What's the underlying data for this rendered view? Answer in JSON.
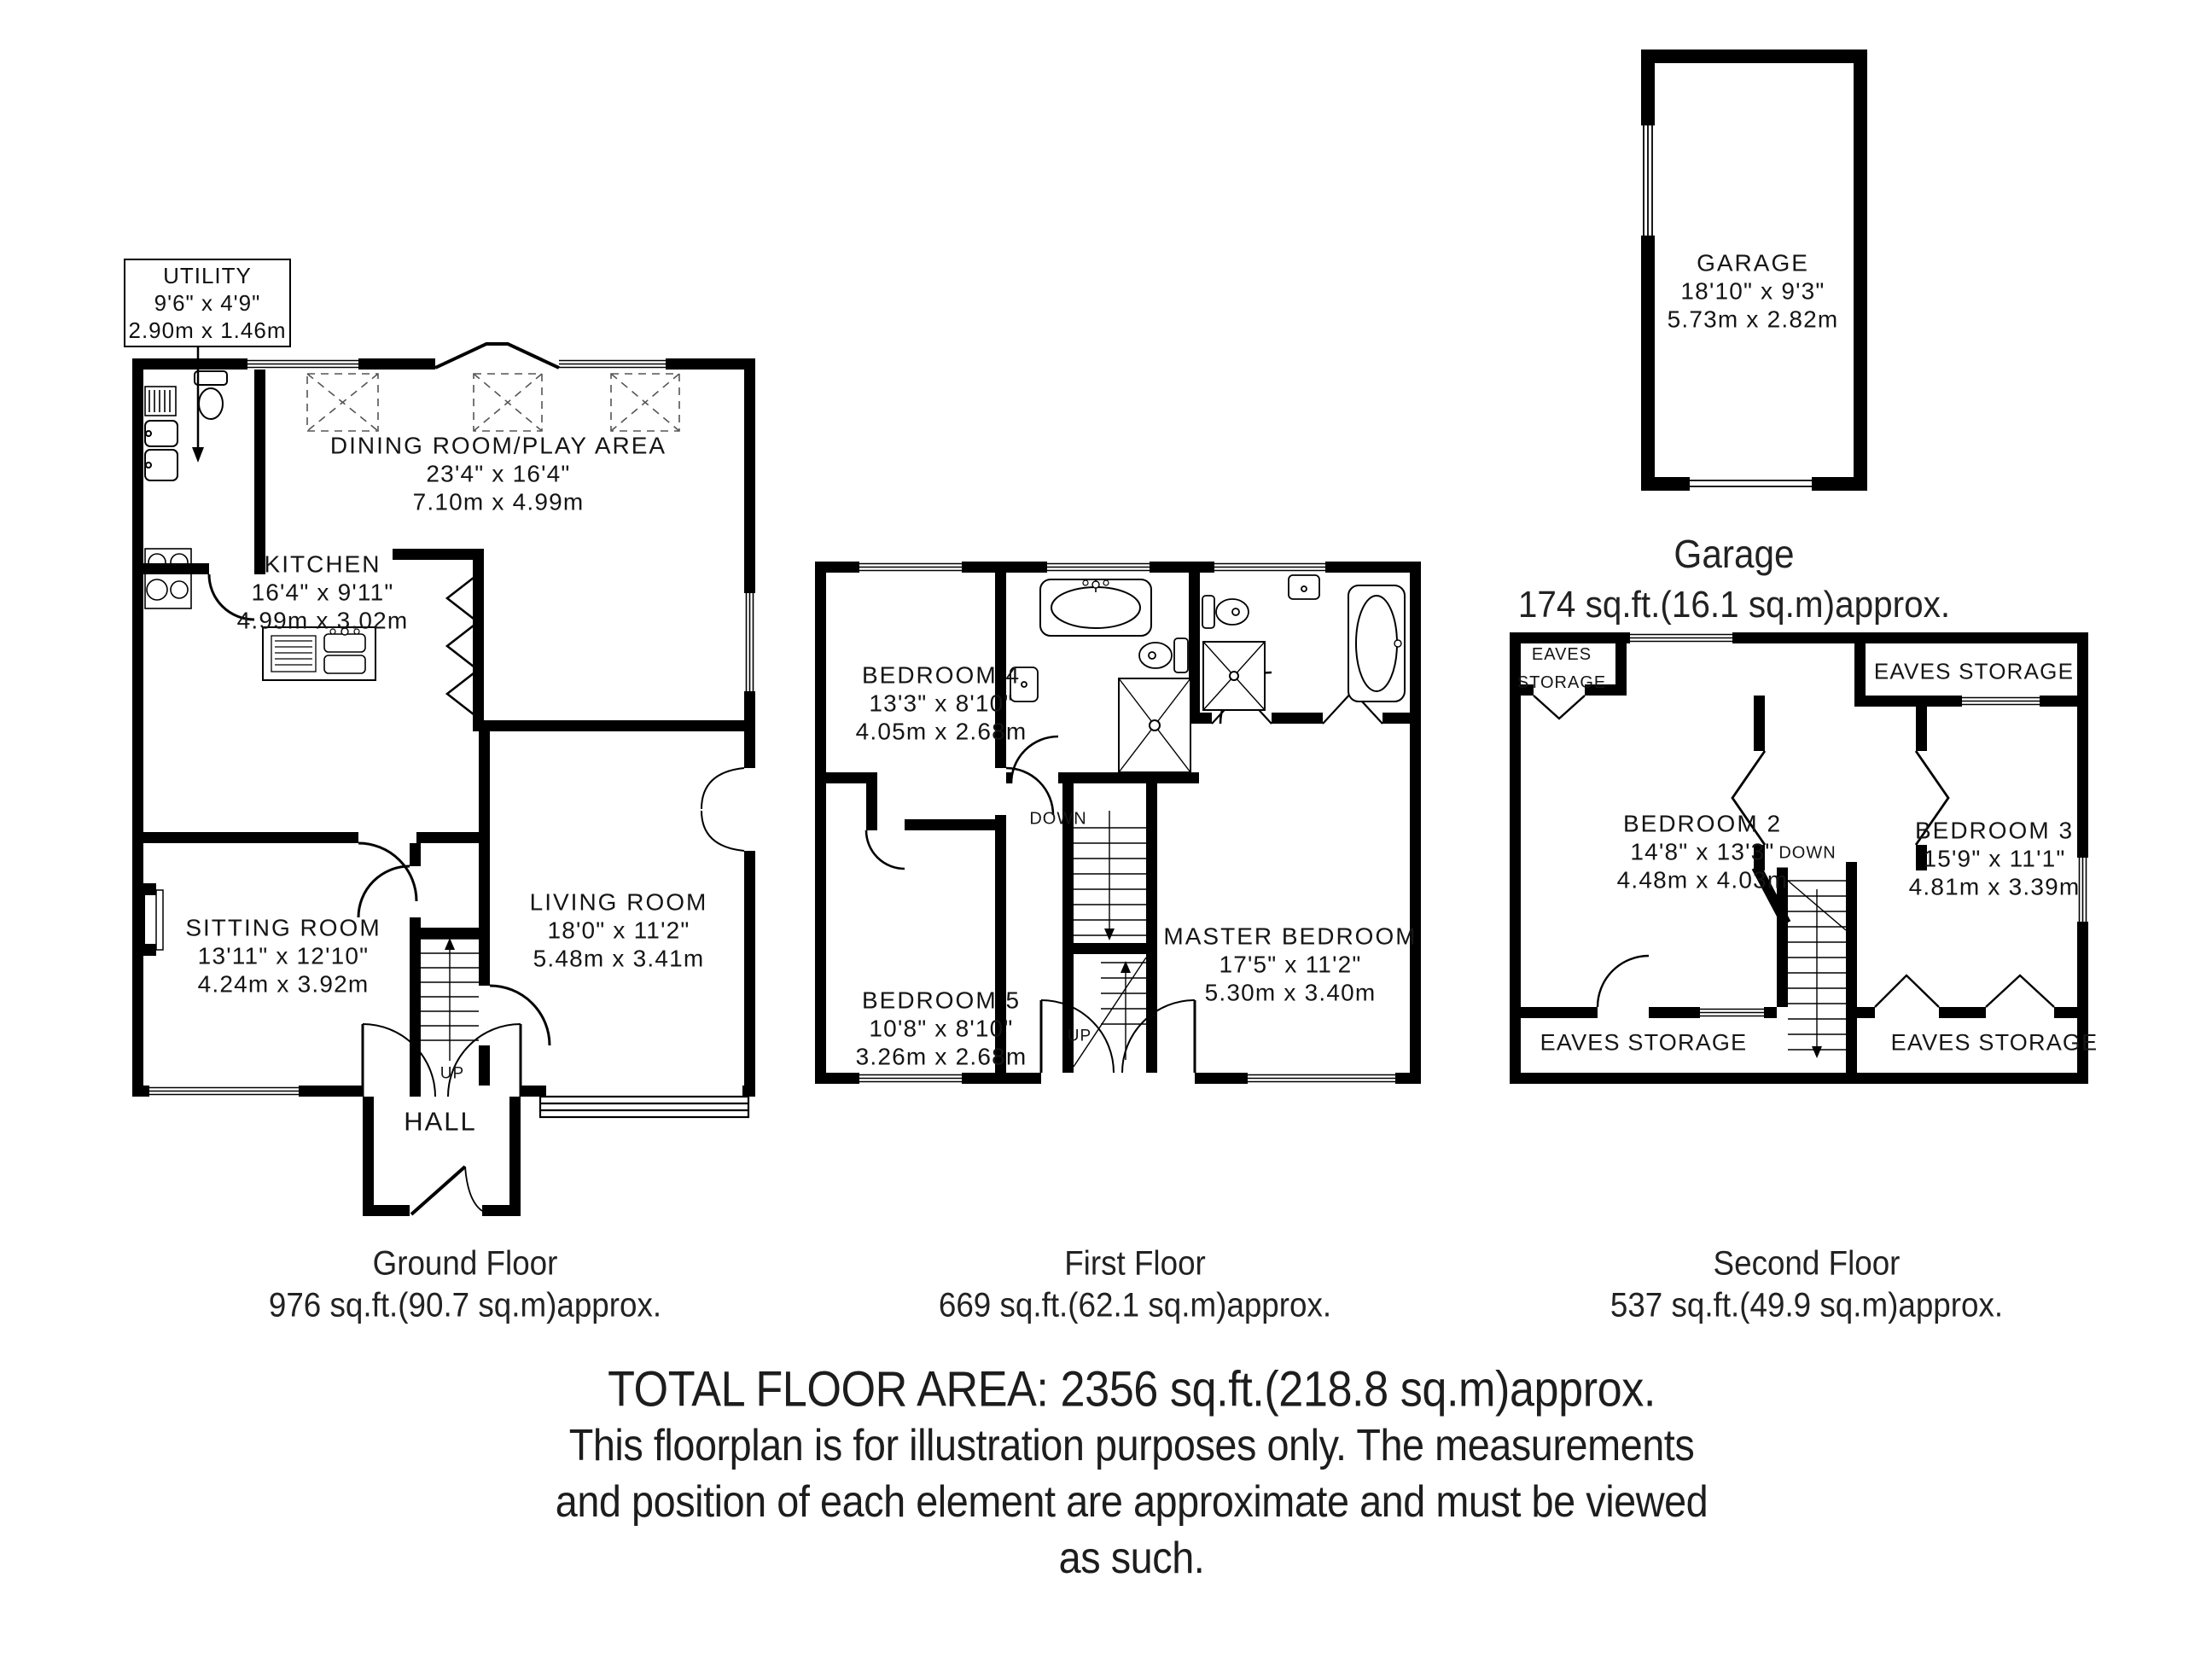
{
  "utility_callout": {
    "name": "UTILITY",
    "imperial": "9'6\" x 4'9\"",
    "metric": "2.90m x 1.46m"
  },
  "ground": {
    "rooms": [
      {
        "name": "DINING ROOM/PLAY AREA",
        "imperial": "23'4\" x 16'4\"",
        "metric": "7.10m x 4.99m"
      },
      {
        "name": "KITCHEN",
        "imperial": "16'4\" x 9'11\"",
        "metric": "4.99m x 3.02m"
      },
      {
        "name": "SITTING ROOM",
        "imperial": "13'11\" x 12'10\"",
        "metric": "4.24m x 3.92m"
      },
      {
        "name": "LIVING ROOM",
        "imperial": "18'0\" x 11'2\"",
        "metric": "5.48m x 3.41m"
      }
    ],
    "hall": "HALL",
    "up": "UP",
    "caption_title": "Ground Floor",
    "caption_area": "976 sq.ft.(90.7 sq.m)approx."
  },
  "first": {
    "rooms": [
      {
        "name": "BEDROOM 4",
        "imperial": "13'3\" x 8'10\"",
        "metric": "4.05m x 2.68m"
      },
      {
        "name": "BEDROOM 5",
        "imperial": "10'8\" x 8'10\"",
        "metric": "3.26m x 2.68m"
      },
      {
        "name": "MASTER BEDROOM",
        "imperial": "17'5\" x 11'2\"",
        "metric": "5.30m x 3.40m"
      }
    ],
    "down": "DOWN",
    "up": "UP",
    "caption_title": "First Floor",
    "caption_area": "669 sq.ft.(62.1 sq.m)approx."
  },
  "second": {
    "rooms": [
      {
        "name": "BEDROOM 2",
        "imperial": "14'8\" x 13'3\"",
        "metric": "4.48m x 4.03m"
      },
      {
        "name": "BEDROOM 3",
        "imperial": "15'9\" x 11'1\"",
        "metric": "4.81m x 3.39m"
      }
    ],
    "eaves_label": "EAVES STORAGE",
    "down": "DOWN",
    "caption_title": "Second Floor",
    "caption_area": "537 sq.ft.(49.9 sq.m)approx."
  },
  "garage": {
    "name": "GARAGE",
    "imperial": "18'10\" x 9'3\"",
    "metric": "5.73m x 2.82m",
    "caption_title": "Garage",
    "caption_area": "174 sq.ft.(16.1 sq.m)approx."
  },
  "footer": {
    "line1": "TOTAL FLOOR AREA: 2356 sq.ft.(218.8 sq.m)approx.",
    "line2": "This floorplan is for illustration purposes only. The measurements",
    "line3": "and position of each element are approximate and must be viewed",
    "line4": "as such."
  }
}
